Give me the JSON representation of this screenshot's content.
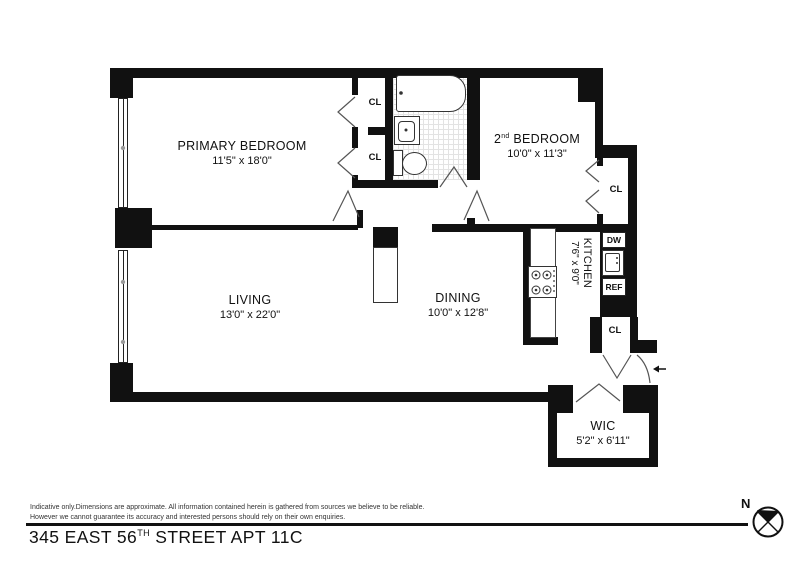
{
  "floorplan": {
    "rooms": {
      "primary_bedroom": {
        "name": "PRIMARY BEDROOM",
        "dims": "11'5\" x 18'0\""
      },
      "second_bedroom": {
        "num": "2",
        "sup": "nd",
        "rest": " BEDROOM",
        "dims": "10'0\" x 11'3\""
      },
      "living": {
        "name": "LIVING",
        "dims": "13'0\" x 22'0\""
      },
      "dining": {
        "name": "DINING",
        "dims": "10'0\" x 12'8\""
      },
      "kitchen": {
        "name": "KITCHEN",
        "dims": "7'6\" x 9'0\""
      },
      "wic": {
        "name": "WIC",
        "dims": "5'2\" x 6'11\""
      }
    },
    "closet_label": "CL",
    "appliances": {
      "dishwasher": "DW",
      "refrigerator": "REF"
    },
    "compass": {
      "north": "N"
    }
  },
  "footer": {
    "disclaimer_line1": "Indicative only.Dimensions are approximate. All information contained herein is gathered from sources we believe to be reliable.",
    "disclaimer_line2": "However we cannot guarantee its accuracy and interested persons should rely on their own enquiries.",
    "address": {
      "prefix": "345 EAST 56",
      "sup": "TH",
      "suffix": " STREET APT 11C"
    }
  }
}
